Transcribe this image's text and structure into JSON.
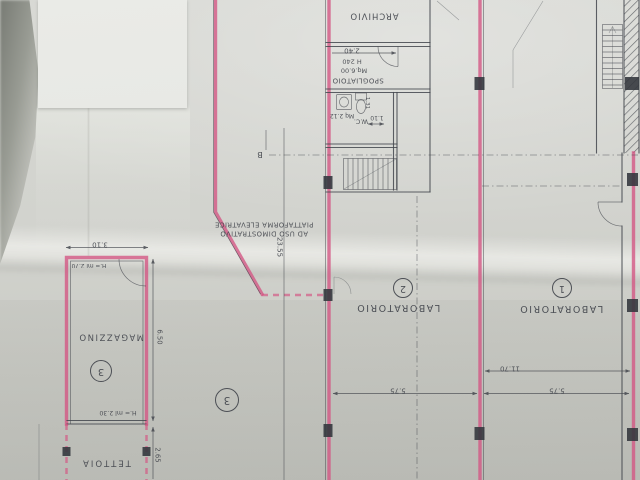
{
  "photo": {
    "description": "Photograph of an architectural floor plan sheet, drawing upside down, demolition walls traced in pink",
    "colors": {
      "highlight": "#d45583",
      "ink": "#43464d",
      "paper": "#d2d3ce",
      "patch": "#e8e9e5",
      "background_edge": "#7c7f78"
    }
  },
  "rooms": {
    "archivio": {
      "label": "ARCHIVIO"
    },
    "spogliatoio": {
      "label": "SPOGLIATOIO",
      "area": "Mq.6.00",
      "height": "H 240"
    },
    "wc": {
      "label": "W.C.",
      "area": "Mq 2.12"
    },
    "laboratorio_2": {
      "label": "LABORATORIO",
      "number": "2"
    },
    "laboratorio_1": {
      "label": "LABORATORIO",
      "number": "1"
    },
    "magazzino": {
      "label": "MAGAZZINO",
      "number": "3",
      "height_front": "H.= ml 2.70",
      "height_rear": "H.= ml 2.30"
    },
    "tettoia": {
      "label": "TETTOIA"
    },
    "open_area": {
      "number": "3"
    },
    "piattaforma": {
      "line1": "PIATTAFORMA ELEVATRICE",
      "line2": "AD USO DIMOSTRATIVO"
    }
  },
  "dimensions": {
    "room_240": "2.40",
    "wc_width": "1.10",
    "wc_depth": "1.31",
    "hall_length": "23.55",
    "lab1_width": "11.70",
    "lab2_span": "5.75",
    "lab1_span": "5.75",
    "magazzino_width": "3.10",
    "magazzino_length": "6.50",
    "tettoia_depth": "2.65"
  },
  "markers": {
    "section": "B"
  }
}
